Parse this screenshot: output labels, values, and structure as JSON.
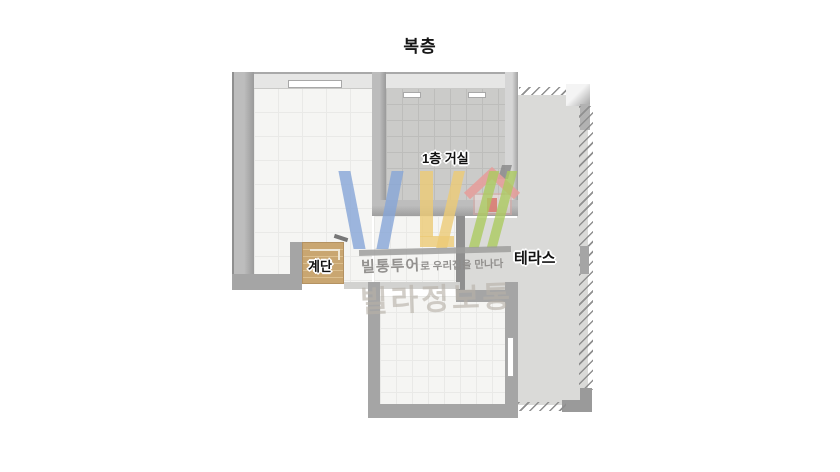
{
  "title": "복층",
  "rooms": {
    "living_room_label": "1층 거실",
    "stairs_label": "계단",
    "terrace_label": "테라스"
  },
  "watermark": {
    "tagline_bold": "빌통투어",
    "tagline_rest": "로 우리집을 만나다",
    "brand": "빌라정보통"
  },
  "colors": {
    "wall": "#a5a5a5",
    "wall_dark": "#8f8f8f",
    "wall_light_face": "#e6e6e5",
    "floor_white": "#f5f5f3",
    "floor_white_grid": "#e9e9e7",
    "floor_gray": "#cbcbc9",
    "floor_gray_grid": "#bdbdbb",
    "terrace_floor": "#dadad8",
    "stairs_wood": "#c9a671",
    "stairs_wood_light": "#dcbf8e",
    "logo_blue": "#86a5d7",
    "logo_yellow": "#eccb75",
    "logo_green": "#abca60",
    "logo_pink": "#e49f9b",
    "logo_bar": "#9e9e9c",
    "tagline_text": "#8e8c8a",
    "brand_text": "#b7b1a8",
    "label_text": "#111111"
  }
}
